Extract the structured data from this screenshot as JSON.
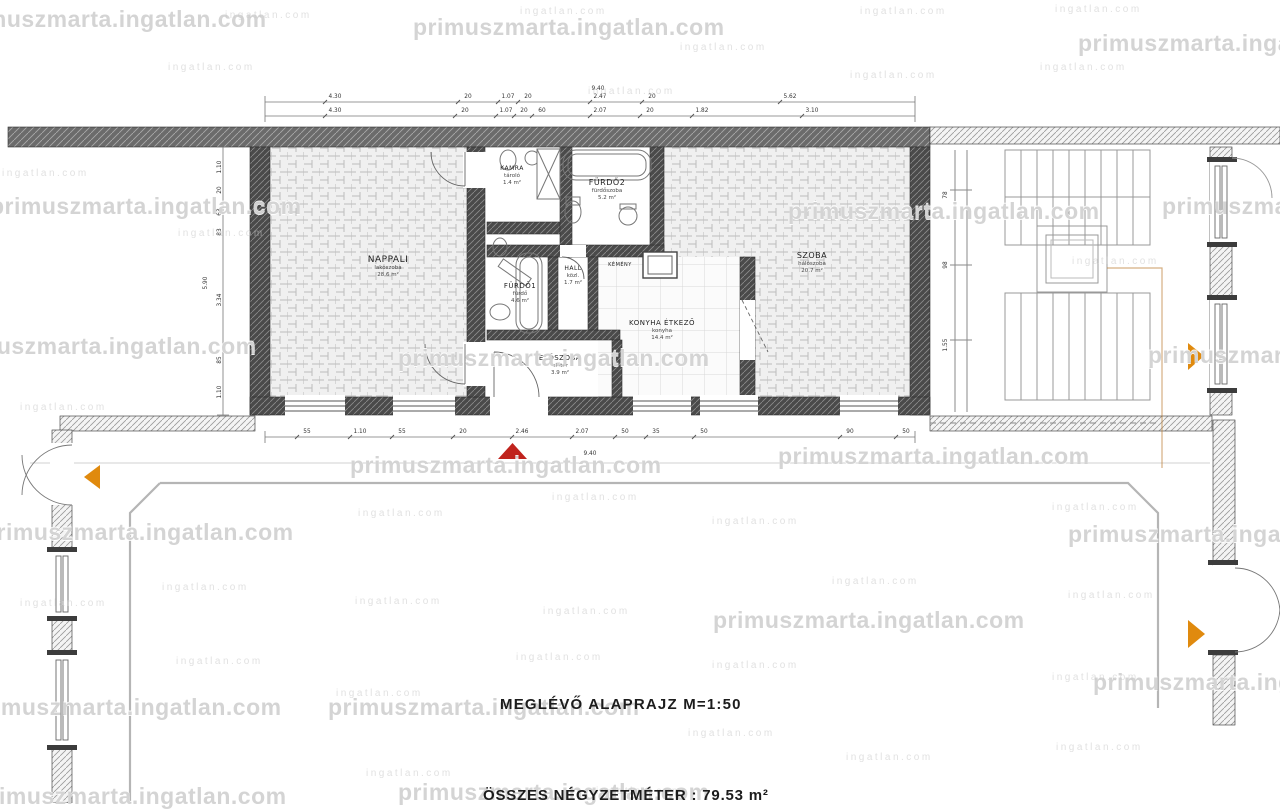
{
  "captions": {
    "plan_title": "MEGLÉVŐ ALAPRAJZ M=1:50",
    "total_area": "ÖSSZES NÉGYZETMÉTER : 79.53 m²"
  },
  "colors": {
    "arrow_orange": "#e08a0e",
    "triangle_red": "#c0231d",
    "label": "#1f1f1f",
    "dim": "#333333",
    "watermark": "#c9c9c9"
  },
  "watermarks": {
    "text": "primuszmarta.ingatlan.com",
    "small_text": "ingatlan.com",
    "large": [
      [
        -45,
        6
      ],
      [
        413,
        14
      ],
      [
        1078,
        30
      ],
      [
        -10,
        193
      ],
      [
        788,
        198
      ],
      [
        1162,
        193
      ],
      [
        -55,
        333
      ],
      [
        398,
        345
      ],
      [
        1148,
        342
      ],
      [
        350,
        452
      ],
      [
        778,
        443
      ],
      [
        -18,
        519
      ],
      [
        1068,
        521
      ],
      [
        713,
        607
      ],
      [
        -30,
        694
      ],
      [
        328,
        694
      ],
      [
        1093,
        669
      ],
      [
        -25,
        783
      ],
      [
        398,
        779
      ]
    ],
    "small": [
      [
        225,
        10
      ],
      [
        520,
        6
      ],
      [
        680,
        42
      ],
      [
        860,
        6
      ],
      [
        1055,
        4
      ],
      [
        168,
        62
      ],
      [
        588,
        86
      ],
      [
        850,
        70
      ],
      [
        1040,
        62
      ],
      [
        2,
        168
      ],
      [
        178,
        228
      ],
      [
        1072,
        256
      ],
      [
        20,
        402
      ],
      [
        358,
        508
      ],
      [
        552,
        492
      ],
      [
        712,
        516
      ],
      [
        1052,
        502
      ],
      [
        162,
        582
      ],
      [
        355,
        596
      ],
      [
        543,
        606
      ],
      [
        832,
        576
      ],
      [
        1068,
        590
      ],
      [
        20,
        598
      ],
      [
        176,
        656
      ],
      [
        516,
        652
      ],
      [
        712,
        660
      ],
      [
        1052,
        672
      ],
      [
        336,
        688
      ],
      [
        688,
        728
      ],
      [
        846,
        752
      ],
      [
        1056,
        742
      ],
      [
        366,
        768
      ],
      [
        596,
        786
      ]
    ]
  },
  "plan": {
    "rooms": [
      {
        "name": "NAPPALI",
        "x": 388,
        "y": 262,
        "size": 9,
        "subs": [
          "lakószoba",
          "28.6 m²"
        ]
      },
      {
        "name": "KAMRA",
        "x": 512,
        "y": 170,
        "size": 6,
        "subs": [
          "tároló",
          "1.4 m²"
        ]
      },
      {
        "name": "FÜRDŐ2",
        "x": 607,
        "y": 185,
        "size": 8,
        "subs": [
          "fürdőszoba",
          "5.2 m²"
        ]
      },
      {
        "name": "FÜRDŐ1",
        "x": 520,
        "y": 288,
        "size": 7,
        "subs": [
          "fürdő",
          "4.6 m²"
        ]
      },
      {
        "name": "HALL",
        "x": 573,
        "y": 270,
        "size": 6,
        "subs": [
          "közl.",
          "1.7 m²"
        ]
      },
      {
        "name": "KONYHA ÉTKEZŐ",
        "x": 662,
        "y": 325,
        "size": 7,
        "subs": [
          "konyha",
          "14.4 m²"
        ]
      },
      {
        "name": "SZOBA",
        "x": 812,
        "y": 258,
        "size": 8,
        "subs": [
          "hálószoba",
          "20.7 m²"
        ]
      },
      {
        "name": "ELŐSZOBA",
        "x": 560,
        "y": 360,
        "size": 7,
        "subs": [
          "előtér",
          "3.9 m²"
        ]
      },
      {
        "name": "KÉMÉNY",
        "x": 620,
        "y": 266,
        "size": 5,
        "subs": []
      }
    ],
    "dimensions": [
      {
        "name": "top-overall",
        "y": 90,
        "items": [
          {
            "t": "9.40",
            "x": 598
          }
        ]
      },
      {
        "name": "top-row-1",
        "y": 98,
        "line": 102,
        "items": [
          {
            "t": "4.30",
            "x": 335
          },
          {
            "t": "20",
            "x": 468
          },
          {
            "t": "1.07",
            "x": 508
          },
          {
            "t": "20",
            "x": 528
          },
          {
            "t": "2.47",
            "x": 600
          },
          {
            "t": "20",
            "x": 652
          },
          {
            "t": "5.62",
            "x": 790
          }
        ]
      },
      {
        "name": "top-row-2",
        "y": 112,
        "line": 116,
        "items": [
          {
            "t": "4.30",
            "x": 335
          },
          {
            "t": "20",
            "x": 465
          },
          {
            "t": "1.07",
            "x": 506
          },
          {
            "t": "20",
            "x": 524
          },
          {
            "t": "60",
            "x": 542
          },
          {
            "t": "2.07",
            "x": 600
          },
          {
            "t": "20",
            "x": 650
          },
          {
            "t": "1.82",
            "x": 702
          },
          {
            "t": "3.10",
            "x": 812
          }
        ]
      },
      {
        "name": "bottom-row",
        "y": 433,
        "line": 437,
        "items": [
          {
            "t": "55",
            "x": 307
          },
          {
            "t": "1.10",
            "x": 360
          },
          {
            "t": "55",
            "x": 402
          },
          {
            "t": "20",
            "x": 463
          },
          {
            "t": "2.46",
            "x": 522
          },
          {
            "t": "2.07",
            "x": 582
          },
          {
            "t": "50",
            "x": 625
          },
          {
            "t": "35",
            "x": 656
          },
          {
            "t": "50",
            "x": 704
          },
          {
            "t": "90",
            "x": 850
          },
          {
            "t": "50",
            "x": 906
          }
        ]
      },
      {
        "name": "bottom-overall",
        "y": 455,
        "items": [
          {
            "t": "9.40",
            "x": 590
          }
        ]
      },
      {
        "name": "left-col",
        "rot": true,
        "items": [
          {
            "t": "1.10",
            "x": 221,
            "y": 167
          },
          {
            "t": "20",
            "x": 221,
            "y": 190
          },
          {
            "t": "63",
            "x": 221,
            "y": 212
          },
          {
            "t": "83",
            "x": 221,
            "y": 232
          },
          {
            "t": "3.34",
            "x": 221,
            "y": 300
          },
          {
            "t": "85",
            "x": 221,
            "y": 360
          },
          {
            "t": "1.10",
            "x": 221,
            "y": 392
          }
        ]
      },
      {
        "name": "left-overall",
        "rot": true,
        "items": [
          {
            "t": "5.90",
            "x": 207,
            "y": 283
          }
        ]
      },
      {
        "name": "stairwell-col",
        "rot": true,
        "items": [
          {
            "t": "78",
            "x": 947,
            "y": 195
          },
          {
            "t": "98",
            "x": 947,
            "y": 265
          },
          {
            "t": "1.55",
            "x": 947,
            "y": 345
          }
        ]
      }
    ]
  }
}
